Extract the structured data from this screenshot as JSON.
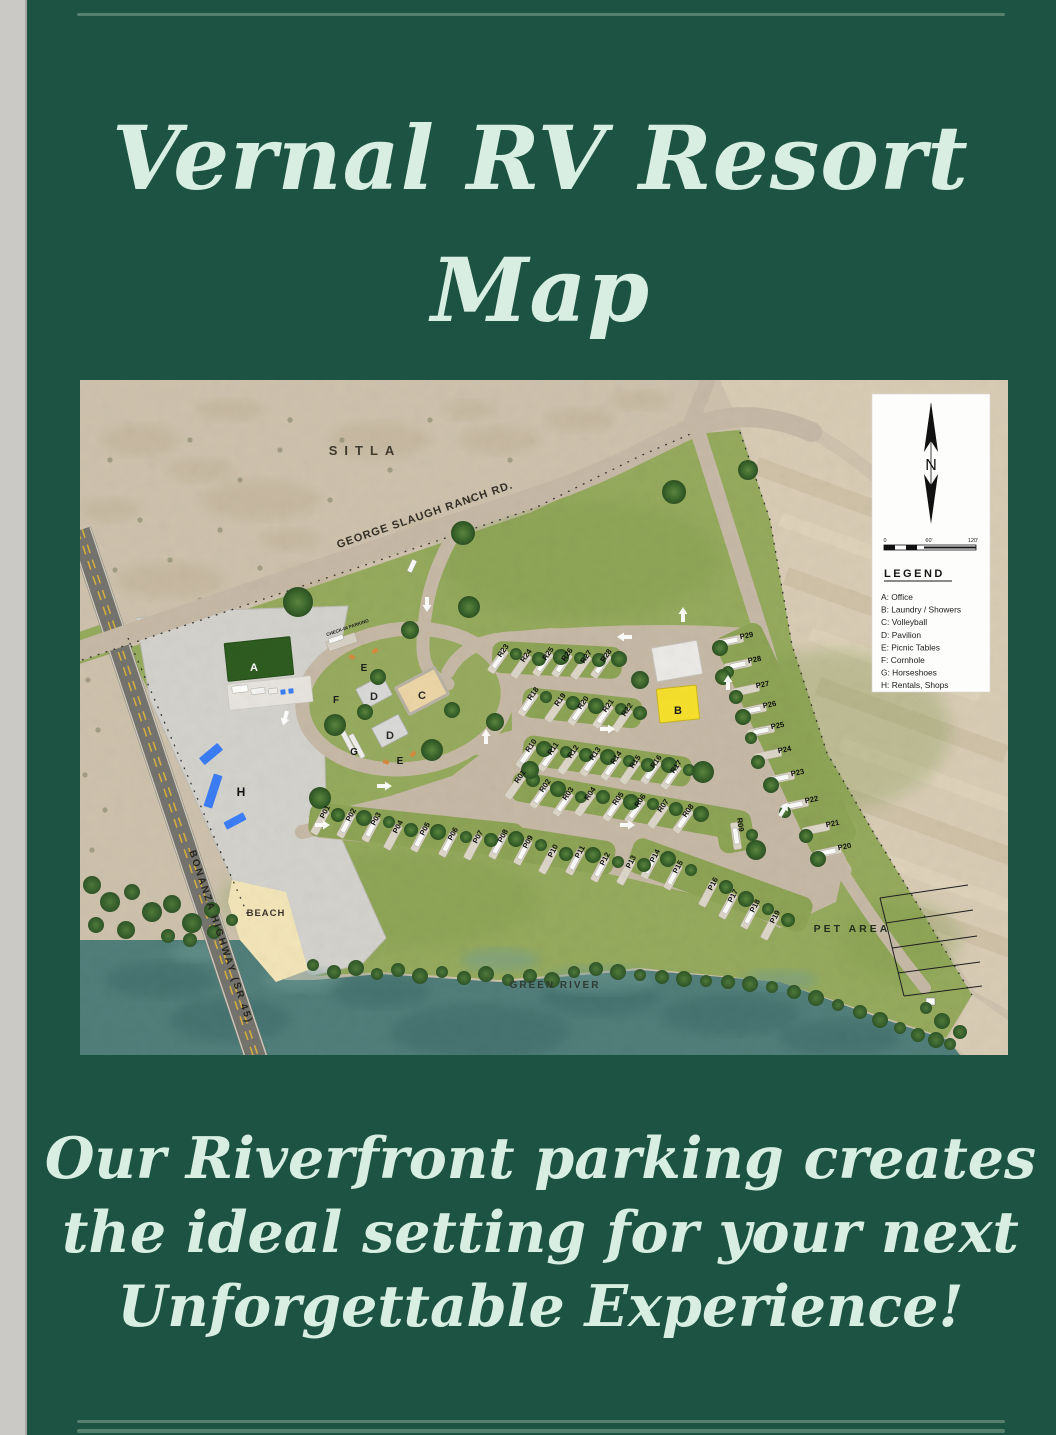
{
  "page": {
    "title_line1": "Vernal RV Resort",
    "title_line2": "Map",
    "footer_line1": "Our Riverfront parking creates",
    "footer_line2": "the ideal setting for your next",
    "footer_line3": "Unforgettable Experience!"
  },
  "colors": {
    "page_background": "#1d5343",
    "title_text": "#d8eee2",
    "divider": "#567f6e",
    "side_strip": "#cac9c6",
    "desert": "#cec2ad",
    "desert_light": "#d9ccb5",
    "resort_green": "#95aa5d",
    "road_tan": "#c6b9a6",
    "highway_gray": "#74736d",
    "gravel": "#d3d2cc",
    "river_teal": "#517e7a",
    "beach_sand": "#f2e5b8",
    "office_green": "#2e5c20",
    "laundry_yellow": "#f6e02c",
    "volleyball_sand": "#ecd6a7",
    "rentals_blue": "#3b7df5",
    "tree_green": "#3f6b2e"
  },
  "map": {
    "area_labels": {
      "sitla": "SITLA",
      "george_slaugh_road": "GEORGE SLAUGH RANCH RD.",
      "bonanza_highway": "BONANZA HIGHWAY (SR 45)",
      "check_in_parking": "CHECK-IN PARKING",
      "beach": "BEACH",
      "green_river": "GREEN RIVER",
      "pet_area": "PET AREA"
    },
    "legend": {
      "north_label": "N",
      "scale_labels": [
        "0",
        "60'",
        "120'"
      ],
      "title": "LEGEND",
      "entries": [
        "A: Office",
        "B: Laundry / Showers",
        "C: Volleyball",
        "D: Pavilion",
        "E: Picnic Tables",
        "F: Cornhole",
        "G: Horseshoes",
        "H: Rentals, Shops"
      ]
    },
    "amenities": [
      {
        "letter": "A",
        "x": 174,
        "y": 287,
        "color": "#ffffff",
        "size": 11
      },
      {
        "letter": "B",
        "x": 598,
        "y": 330,
        "color": "#1c1c1c",
        "size": 11
      },
      {
        "letter": "C",
        "x": 342,
        "y": 315,
        "color": "#2a2a2a",
        "size": 11
      },
      {
        "letter": "D",
        "x": 294,
        "y": 316,
        "color": "#2a2a2a",
        "size": 11
      },
      {
        "letter": "D",
        "x": 310,
        "y": 355,
        "color": "#2a2a2a",
        "size": 11
      },
      {
        "letter": "E",
        "x": 284,
        "y": 287,
        "color": "#1c1c1c",
        "size": 10
      },
      {
        "letter": "E",
        "x": 320,
        "y": 380,
        "color": "#1c1c1c",
        "size": 10
      },
      {
        "letter": "F",
        "x": 256,
        "y": 319,
        "color": "#1c1c1c",
        "size": 10
      },
      {
        "letter": "G",
        "x": 274,
        "y": 371,
        "color": "#1c1c1c",
        "size": 10
      },
      {
        "letter": "H",
        "x": 161,
        "y": 412,
        "color": "#111111",
        "size": 12
      }
    ],
    "parking_spots": [
      {
        "id": "R23",
        "x": 425,
        "y": 272,
        "rot": -55
      },
      {
        "id": "R24",
        "x": 448,
        "y": 277,
        "rot": -55
      },
      {
        "id": "R25",
        "x": 470,
        "y": 275,
        "rot": -55
      },
      {
        "id": "R26",
        "x": 489,
        "y": 276,
        "rot": -55
      },
      {
        "id": "R27",
        "x": 508,
        "y": 278,
        "rot": -55
      },
      {
        "id": "R28",
        "x": 528,
        "y": 277,
        "rot": -55
      },
      {
        "id": "R18",
        "x": 455,
        "y": 315,
        "rot": -55
      },
      {
        "id": "R19",
        "x": 482,
        "y": 321,
        "rot": -55
      },
      {
        "id": "R20",
        "x": 505,
        "y": 324,
        "rot": -55
      },
      {
        "id": "R21",
        "x": 530,
        "y": 327,
        "rot": -55
      },
      {
        "id": "R22",
        "x": 549,
        "y": 331,
        "rot": -55
      },
      {
        "id": "R10",
        "x": 453,
        "y": 367,
        "rot": -55
      },
      {
        "id": "R11",
        "x": 475,
        "y": 370,
        "rot": -55
      },
      {
        "id": "R12",
        "x": 495,
        "y": 373,
        "rot": -55
      },
      {
        "id": "R13",
        "x": 517,
        "y": 375,
        "rot": -55
      },
      {
        "id": "R14",
        "x": 538,
        "y": 379,
        "rot": -55
      },
      {
        "id": "R15",
        "x": 557,
        "y": 383,
        "rot": -55
      },
      {
        "id": "R16",
        "x": 578,
        "y": 383,
        "rot": -55
      },
      {
        "id": "R17",
        "x": 598,
        "y": 388,
        "rot": -55
      },
      {
        "id": "R01",
        "x": 442,
        "y": 398,
        "rot": -55
      },
      {
        "id": "R02",
        "x": 467,
        "y": 407,
        "rot": -55
      },
      {
        "id": "R03",
        "x": 490,
        "y": 415,
        "rot": -55
      },
      {
        "id": "R04",
        "x": 512,
        "y": 415,
        "rot": -55
      },
      {
        "id": "R05",
        "x": 540,
        "y": 420,
        "rot": -55
      },
      {
        "id": "R06",
        "x": 562,
        "y": 422,
        "rot": -55
      },
      {
        "id": "R07",
        "x": 585,
        "y": 427,
        "rot": -55
      },
      {
        "id": "R08",
        "x": 610,
        "y": 432,
        "rot": -55
      },
      {
        "id": "R09",
        "x": 658,
        "y": 445,
        "rot": 82
      },
      {
        "id": "P01",
        "x": 247,
        "y": 433,
        "rot": -62
      },
      {
        "id": "P02",
        "x": 273,
        "y": 436,
        "rot": -62
      },
      {
        "id": "P03",
        "x": 298,
        "y": 440,
        "rot": -62
      },
      {
        "id": "P04",
        "x": 320,
        "y": 448,
        "rot": -62
      },
      {
        "id": "P05",
        "x": 347,
        "y": 450,
        "rot": -62
      },
      {
        "id": "P06",
        "x": 375,
        "y": 455,
        "rot": -62
      },
      {
        "id": "P07",
        "x": 400,
        "y": 458,
        "rot": -62
      },
      {
        "id": "P08",
        "x": 425,
        "y": 457,
        "rot": -62
      },
      {
        "id": "P09",
        "x": 450,
        "y": 463,
        "rot": -62
      },
      {
        "id": "P10",
        "x": 475,
        "y": 472,
        "rot": -62
      },
      {
        "id": "P11",
        "x": 502,
        "y": 473,
        "rot": -62
      },
      {
        "id": "P12",
        "x": 527,
        "y": 480,
        "rot": -62
      },
      {
        "id": "P13",
        "x": 553,
        "y": 483,
        "rot": -62
      },
      {
        "id": "P14",
        "x": 577,
        "y": 477,
        "rot": -62
      },
      {
        "id": "P15",
        "x": 600,
        "y": 488,
        "rot": -62
      },
      {
        "id": "P16",
        "x": 635,
        "y": 505,
        "rot": -62
      },
      {
        "id": "P17",
        "x": 655,
        "y": 517,
        "rot": -62
      },
      {
        "id": "P18",
        "x": 677,
        "y": 527,
        "rot": -62
      },
      {
        "id": "P19",
        "x": 697,
        "y": 538,
        "rot": -62
      },
      {
        "id": "P29",
        "x": 667,
        "y": 258,
        "rot": -12
      },
      {
        "id": "P28",
        "x": 675,
        "y": 282,
        "rot": -12
      },
      {
        "id": "P27",
        "x": 683,
        "y": 307,
        "rot": -12
      },
      {
        "id": "P26",
        "x": 690,
        "y": 327,
        "rot": -12
      },
      {
        "id": "P25",
        "x": 698,
        "y": 348,
        "rot": -12
      },
      {
        "id": "P24",
        "x": 705,
        "y": 372,
        "rot": -12
      },
      {
        "id": "P23",
        "x": 718,
        "y": 395,
        "rot": -12
      },
      {
        "id": "P22",
        "x": 732,
        "y": 422,
        "rot": -12
      },
      {
        "id": "P21",
        "x": 753,
        "y": 446,
        "rot": -12
      },
      {
        "id": "P20",
        "x": 765,
        "y": 469,
        "rot": -12
      }
    ]
  }
}
